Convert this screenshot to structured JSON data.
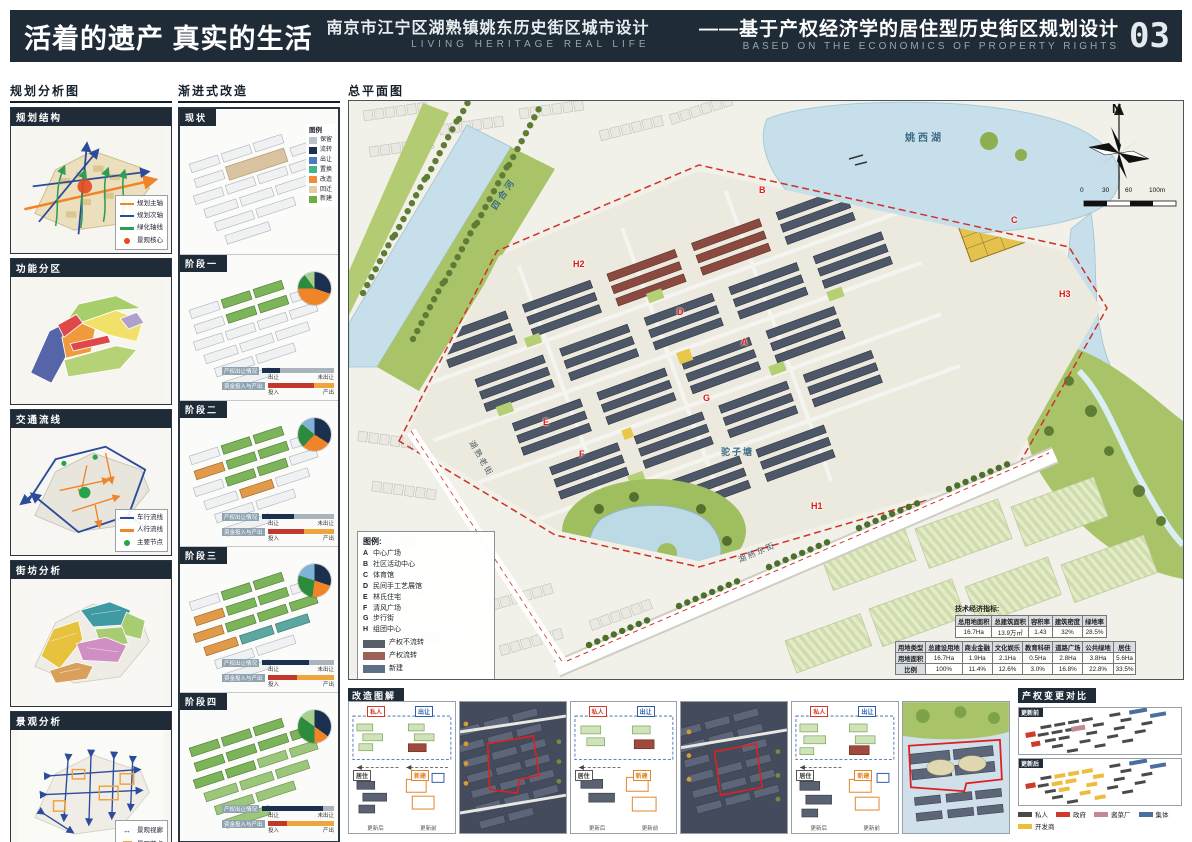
{
  "header": {
    "title_cn": "活着的遗产 真实的生活",
    "subtitle_cn": "南京市江宁区湖熟镇姚东历史街区城市设计",
    "subtitle_en": "LIVING HERITAGE  REAL LIFE",
    "right_title_cn": "——基于产权经济学的居住型历史街区规划设计",
    "right_title_en": "BASED ON THE ECONOMICS OF PROPERTY RIGHTS",
    "page_number": "03",
    "bar_color": "#1f2b37"
  },
  "analysis": {
    "section_title": "规划分析图",
    "structure": {
      "title": "规划结构",
      "legend": [
        {
          "label": "规划主轴",
          "color": "#f08428"
        },
        {
          "label": "规划次轴",
          "color": "#2b4b9b"
        },
        {
          "label": "绿化轴线",
          "color": "#2e9e57"
        },
        {
          "label": "景观核心",
          "color": "#e8491f"
        }
      ]
    },
    "zoning": {
      "title": "功能分区"
    },
    "traffic": {
      "title": "交通流线",
      "legend": [
        {
          "label": "车行流线",
          "color": "#2b4b9b"
        },
        {
          "label": "人行流线",
          "color": "#f08428"
        },
        {
          "label": "主要节点",
          "color": "#27a44a"
        }
      ]
    },
    "blocks": {
      "title": "街坊分析"
    },
    "landscape": {
      "title": "景观分析",
      "legend": [
        {
          "label": "景观视廊",
          "color": "#2b4b9b",
          "symbol": "↔"
        },
        {
          "label": "景观节点",
          "color": "#f0a23e"
        }
      ]
    }
  },
  "renewal": {
    "section_title": "渐进式改造",
    "status": {
      "title": "现状",
      "legend_title": "图例",
      "legend": [
        {
          "label": "保留",
          "color": "#b9c2c6"
        },
        {
          "label": "流转",
          "color": "#1b2f4e"
        },
        {
          "label": "出让",
          "color": "#4a7bc0"
        },
        {
          "label": "置换",
          "color": "#43b58c"
        },
        {
          "label": "改造",
          "color": "#f08a3c"
        },
        {
          "label": "回迁",
          "color": "#e3cda2"
        },
        {
          "label": "新建",
          "color": "#6fae3f"
        }
      ]
    },
    "bar1_label": "产权出让情况",
    "bar1_a": "出让",
    "bar1_b": "未出让",
    "bar2_label": "资金投入与产出",
    "bar2_a": "投入",
    "bar2_b": "产出",
    "stages": [
      {
        "title": "阶段一",
        "sold": 25,
        "invest": 70,
        "pie": [
          {
            "color": "#1b2f4e",
            "pct": 30
          },
          {
            "color": "#f08428",
            "pct": 45
          },
          {
            "color": "#2e8b3d",
            "pct": 15
          },
          {
            "color": "#a8d08d",
            "pct": 10
          }
        ]
      },
      {
        "title": "阶段二",
        "sold": 45,
        "invest": 55,
        "pie": [
          {
            "color": "#1b2f4e",
            "pct": 34
          },
          {
            "color": "#f08428",
            "pct": 28
          },
          {
            "color": "#2e8b3d",
            "pct": 24
          },
          {
            "color": "#7fb2d9",
            "pct": 14
          }
        ]
      },
      {
        "title": "阶段三",
        "sold": 65,
        "invest": 45,
        "pie": [
          {
            "color": "#1b2f4e",
            "pct": 30
          },
          {
            "color": "#f08428",
            "pct": 22
          },
          {
            "color": "#2e8b3d",
            "pct": 28
          },
          {
            "color": "#7fb2d9",
            "pct": 20
          }
        ]
      },
      {
        "title": "阶段四",
        "sold": 85,
        "invest": 30,
        "pie": [
          {
            "color": "#1b2f4e",
            "pct": 35
          },
          {
            "color": "#f08428",
            "pct": 15
          },
          {
            "color": "#2e8b3d",
            "pct": 35
          },
          {
            "color": "#a8d08d",
            "pct": 15
          }
        ]
      }
    ]
  },
  "master_plan": {
    "section_title": "总平面图",
    "north_label": "N",
    "scale_labels": [
      "0",
      "30",
      "60",
      "100m"
    ],
    "place_labels": {
      "lake": "姚西湖",
      "river": "四合河",
      "pond": "驼子塘",
      "street_east": "湖熟东街",
      "street_old": "湖熟老街"
    },
    "marks": [
      {
        "text": "A"
      },
      {
        "text": "B"
      },
      {
        "text": "C"
      },
      {
        "text": "D"
      },
      {
        "text": "E"
      },
      {
        "text": "F"
      },
      {
        "text": "G"
      },
      {
        "text": "H1"
      },
      {
        "text": "H2"
      },
      {
        "text": "H3"
      }
    ],
    "legend": {
      "title": "图例:",
      "items": [
        {
          "key": "A",
          "label": "中心广场"
        },
        {
          "key": "B",
          "label": "社区活动中心"
        },
        {
          "key": "C",
          "label": "体育馆"
        },
        {
          "key": "D",
          "label": "民间手工艺展馆"
        },
        {
          "key": "E",
          "label": "林氏住宅"
        },
        {
          "key": "F",
          "label": "清风广场"
        },
        {
          "key": "G",
          "label": "步行街"
        },
        {
          "key": "H",
          "label": "组团中心"
        }
      ],
      "swatches": [
        {
          "label": "产权不流转",
          "color": "#565e66"
        },
        {
          "label": "产权流转",
          "color": "#9c6258"
        },
        {
          "label": "新建",
          "color": "#5c7186"
        }
      ]
    },
    "indicators": {
      "title": "技术经济指标:",
      "table1": [
        [
          "总用地面积",
          "总建筑面积",
          "容积率",
          "建筑密度",
          "绿地率"
        ],
        [
          "16.7Ha",
          "13.9万㎡",
          "1.43",
          "32%",
          "28.5%"
        ]
      ],
      "table2": [
        [
          "用地类型",
          "总建设用地",
          "商业金融",
          "文化娱乐",
          "教育科研",
          "道路广场",
          "公共绿地",
          "居住"
        ],
        [
          "用地面积",
          "16.7Ha",
          "1.9Ha",
          "2.1Ha",
          "0.5Ha",
          "2.8Ha",
          "3.8Ha",
          "5.6Ha"
        ],
        [
          "比例",
          "100%",
          "11.4%",
          "12.6%",
          "3.0%",
          "16.8%",
          "22.8%",
          "33.5%"
        ]
      ]
    }
  },
  "bottom": {
    "diagrams": {
      "section_title": "改造图解",
      "tag_private": "私人",
      "tag_transfer": "出让",
      "tag_residence": "居住",
      "tag_newbuild": "新建",
      "arrow_before": "更新前",
      "arrow_after": "更新后"
    },
    "comparison": {
      "section_title": "产权变更对比",
      "map1_label": "更新前",
      "map2_label": "更新后",
      "legend": [
        {
          "label": "私人",
          "color": "#4a4a4a"
        },
        {
          "label": "政府",
          "color": "#d03a2a"
        },
        {
          "label": "酱菜厂",
          "color": "#c08a94"
        },
        {
          "label": "集体",
          "color": "#4a6f9c"
        },
        {
          "label": "开发商",
          "color": "#eebd3f"
        }
      ]
    }
  }
}
